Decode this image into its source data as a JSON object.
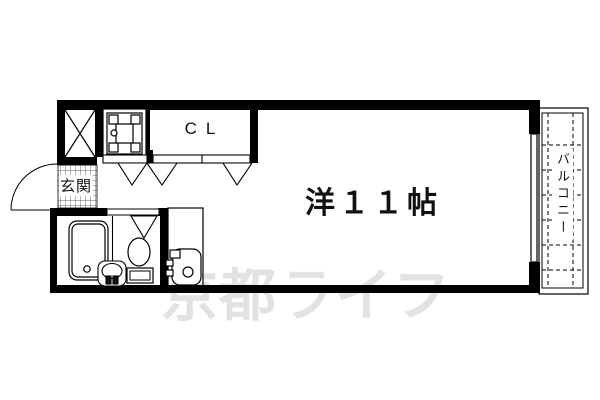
{
  "plan": {
    "room": {
      "label": "洋１１帖"
    },
    "closet": {
      "label": "CL"
    },
    "entrance": {
      "label": "玄関"
    },
    "balcony": {
      "label": "バルコニー"
    },
    "watermark": {
      "text": "京都ライフ",
      "color": "#e2e2e2"
    },
    "colors": {
      "line": "#000000",
      "background": "#ffffff"
    },
    "fixtures": [
      "shaft-x-box",
      "equipment-box",
      "closet-folding-doors",
      "entrance-door-swing",
      "bathtub",
      "washbasin",
      "toilet",
      "vanity-unit",
      "window",
      "balcony-tiles"
    ]
  }
}
